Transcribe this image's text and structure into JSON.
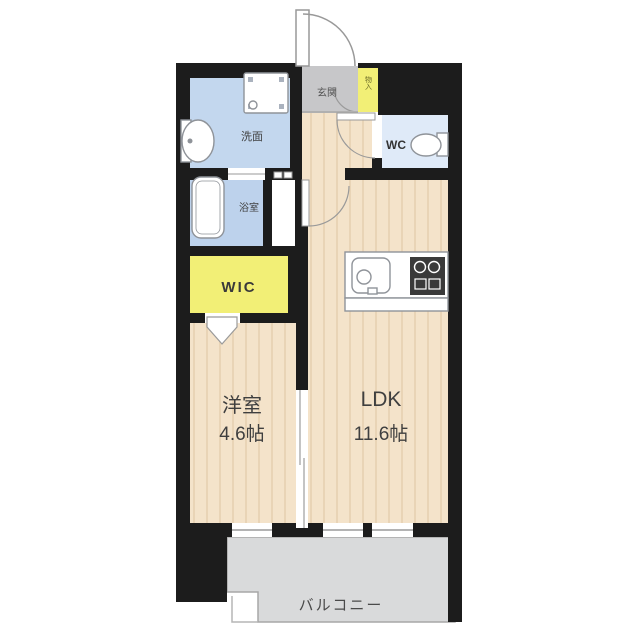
{
  "plan": {
    "rooms": {
      "genkan": {
        "label": "玄関"
      },
      "shoe_storage": {
        "label": "物入"
      },
      "senmen": {
        "label": "洗面"
      },
      "wc": {
        "label": "WC"
      },
      "bath": {
        "label": "浴室"
      },
      "wic": {
        "label": "WIC"
      },
      "bedroom": {
        "label": "洋室",
        "size": "4.6帖"
      },
      "ldk": {
        "label": "LDK",
        "size": "11.6帖"
      },
      "balcony": {
        "label": "バルコニー"
      }
    },
    "fixtures": [
      "entrance-door",
      "shoe-cabinet-door",
      "washer-pan-icon",
      "sink-icon",
      "bathtub-icon",
      "toilet-icon",
      "kitchen-sink-icon",
      "stove-icon",
      "hinged-door",
      "folding-door",
      "sliding-door",
      "window"
    ],
    "colors": {
      "wall": "#1c1c1c",
      "floor_wood": "#f4e3ca",
      "floor_wood_grain": "#e9d4b6",
      "genkan_gray": "#c7c7c9",
      "water_blue": "#c3d7ee",
      "bath_blue": "#bdd2ec",
      "wc_blue": "#dfeaf8",
      "wic_yellow": "#f2ef76",
      "balcony_gray": "#d9dadb",
      "fixture_stroke": "#8f9399",
      "label": "#3f3f3f"
    }
  }
}
